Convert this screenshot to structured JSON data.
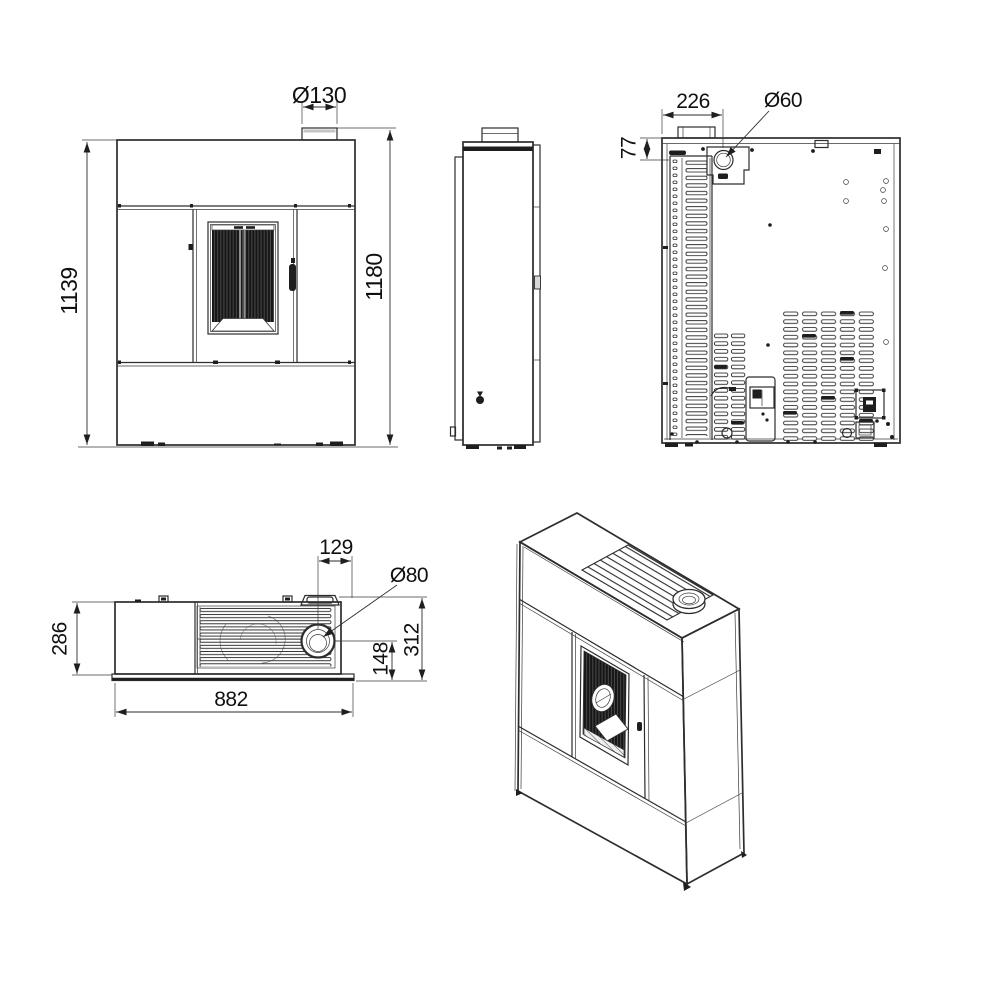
{
  "views": {
    "front": {
      "body_height": "1139",
      "total_height": "1180",
      "flue_diameter": "Ø130"
    },
    "rear": {
      "flue_center_from_left": "226",
      "inlet_center_from_top": "77",
      "air_inlet_diameter": "Ø60"
    },
    "top": {
      "flue_center_from_right": "129",
      "flue_diameter": "Ø80",
      "body_depth": "286",
      "total_depth": "312",
      "flue_center_from_front": "148",
      "total_width": "882"
    }
  }
}
